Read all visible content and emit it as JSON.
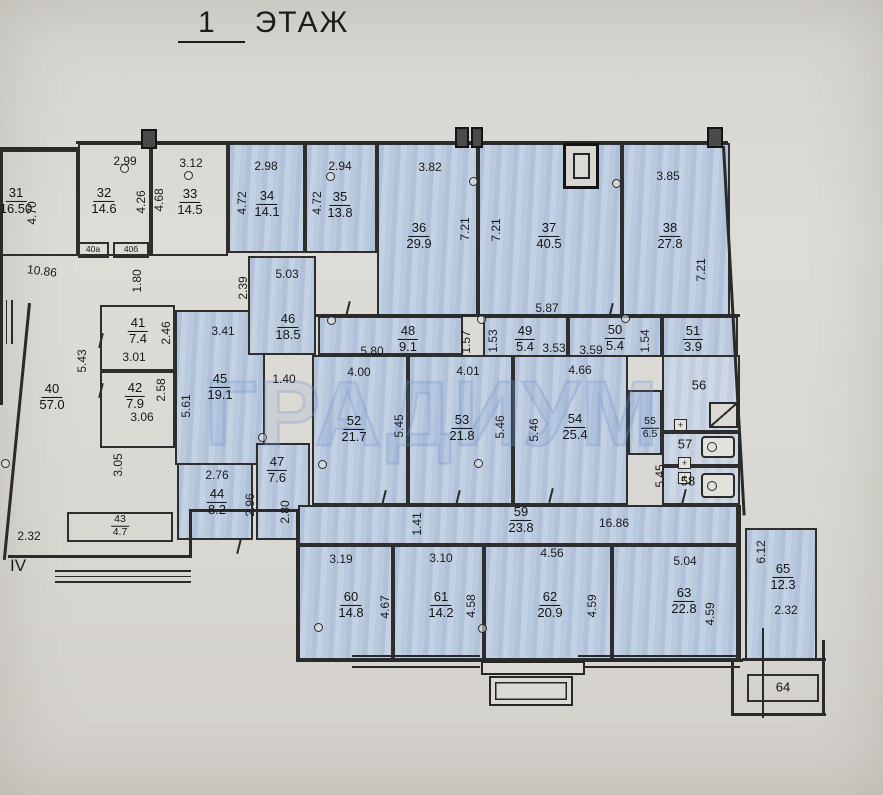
{
  "title_number": "1",
  "title_word": "ЭТАЖ",
  "section_marker": "IV",
  "watermark": "ГРАДИУМ",
  "symbols": {
    "plus": "+"
  },
  "rooms": {
    "31": {
      "number": "31",
      "area": "16.50"
    },
    "32": {
      "number": "32",
      "area": "14.6"
    },
    "33": {
      "number": "33",
      "area": "14.5"
    },
    "34": {
      "number": "34",
      "area": "14.1"
    },
    "35": {
      "number": "35",
      "area": "13.8"
    },
    "36": {
      "number": "36",
      "area": "29.9"
    },
    "37": {
      "number": "37",
      "area": "40.5"
    },
    "38": {
      "number": "38",
      "area": "27.8"
    },
    "40": {
      "number": "40",
      "area": "57.0"
    },
    "40a": {
      "number": "40а",
      "area": ""
    },
    "40b": {
      "number": "40б",
      "area": ""
    },
    "41": {
      "number": "41",
      "area": "7.4"
    },
    "42": {
      "number": "42",
      "area": "7.9"
    },
    "43": {
      "number": "43",
      "area": "4.7"
    },
    "44": {
      "number": "44",
      "area": "8.2"
    },
    "45": {
      "number": "45",
      "area": "19.1"
    },
    "46": {
      "number": "46",
      "area": "18.5"
    },
    "47": {
      "number": "47",
      "area": "7.6"
    },
    "48": {
      "number": "48",
      "area": "9.1"
    },
    "49": {
      "number": "49",
      "area": "5.4"
    },
    "50": {
      "number": "50",
      "area": "5.4"
    },
    "51": {
      "number": "51",
      "area": "3.9"
    },
    "52": {
      "number": "52",
      "area": "21.7"
    },
    "53": {
      "number": "53",
      "area": "21.8"
    },
    "54": {
      "number": "54",
      "area": "25.4"
    },
    "55": {
      "number": "55",
      "area": "6.5"
    },
    "56": {
      "number": "56",
      "area": ""
    },
    "57": {
      "number": "57",
      "area": ""
    },
    "58": {
      "number": "58",
      "area": ""
    },
    "59": {
      "number": "59",
      "area": "23.8"
    },
    "60": {
      "number": "60",
      "area": "14.8"
    },
    "61": {
      "number": "61",
      "area": "14.2"
    },
    "62": {
      "number": "62",
      "area": "20.9"
    },
    "63": {
      "number": "63",
      "area": "22.8"
    },
    "64": {
      "number": "64",
      "area": ""
    },
    "65": {
      "number": "65",
      "area": "12.3"
    }
  },
  "dims": [
    "2.99",
    "3.12",
    "2.98",
    "2.94",
    "3.82",
    "3.85",
    "4.70",
    "4.26",
    "4.68",
    "4.72",
    "4.72",
    "7.21",
    "7.21",
    "7.21",
    "10.86",
    "5.03",
    "1.80",
    "2.39",
    "3.41",
    "5.87",
    "5.80",
    "1.57",
    "1.53",
    "3.53",
    "3.59",
    "1.54",
    "2.46",
    "3.01",
    "2.58",
    "3.06",
    "5.43",
    "5.61",
    "1.40",
    "4.00",
    "4.01",
    "4.66",
    "5.45",
    "5.46",
    "5.46",
    "5.45",
    "3.05",
    "2.76",
    "2.96",
    "2.80",
    "2.32",
    "1.41",
    "16.86",
    "6.12",
    "3.19",
    "3.10",
    "4.56",
    "5.04",
    "4.67",
    "4.58",
    "4.59",
    "4.59",
    "2.32"
  ]
}
